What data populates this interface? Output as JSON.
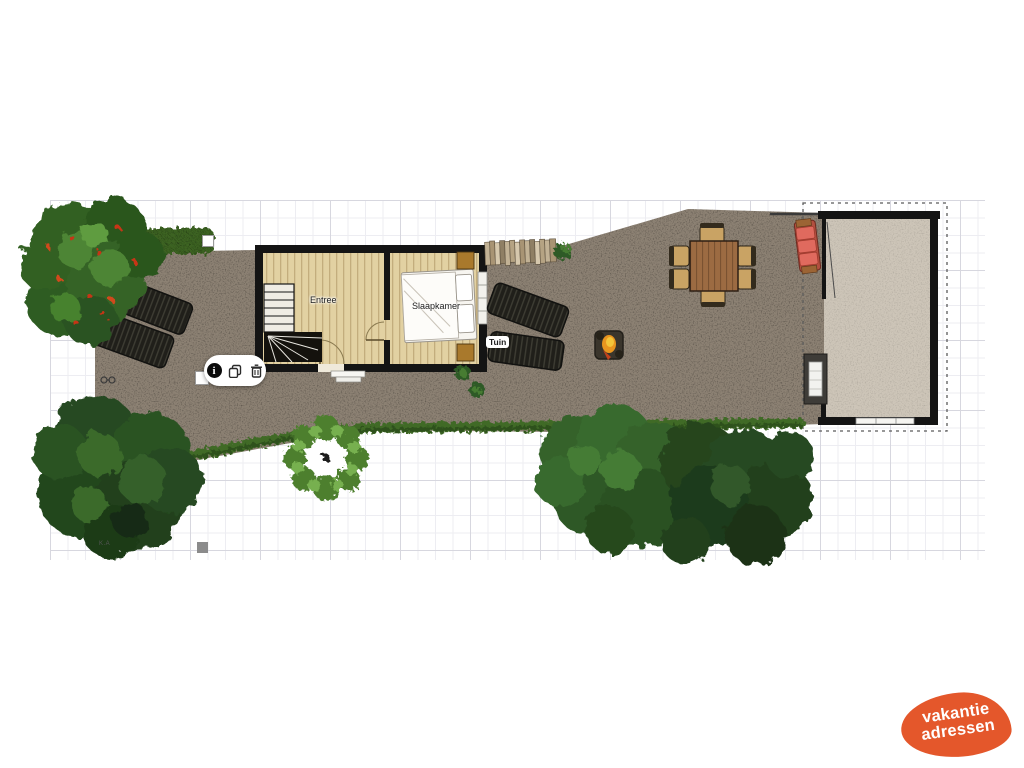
{
  "plan": {
    "rooms": [
      {
        "label": "Entree"
      },
      {
        "label": "Slaapkamer"
      }
    ],
    "garden_label": "Tuin",
    "note": "K.A",
    "colors": {
      "terrain": "#8c8173",
      "wood_floor": "#e2d1a2",
      "wall": "#141414",
      "annex_floor": "#cdc5b8",
      "hedge": "#3c6322",
      "logo_orange": "#e4572b"
    }
  },
  "toolbar": {
    "buttons": [
      {
        "name": "info"
      },
      {
        "name": "duplicate"
      },
      {
        "name": "delete"
      }
    ]
  },
  "logo": {
    "line1": "vakantie",
    "line2": "adressen"
  }
}
